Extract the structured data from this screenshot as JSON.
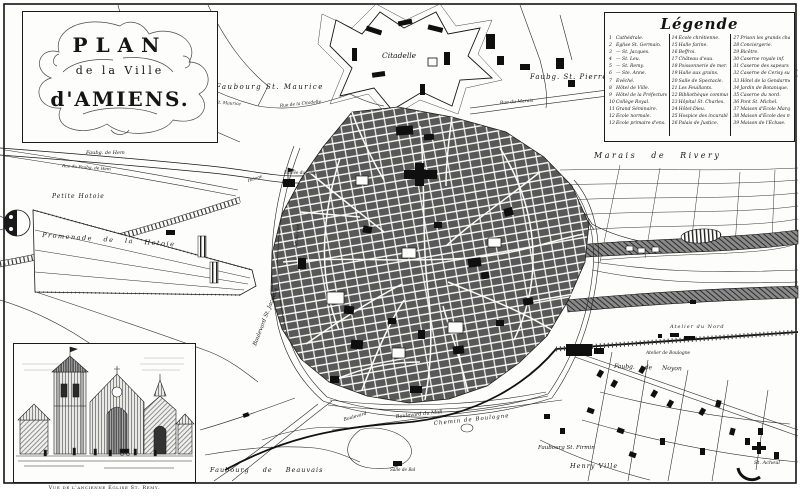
{
  "cartouche": {
    "line1": "PLAN",
    "line2": "de la Ville",
    "line3": "d'AMIENS."
  },
  "legend": {
    "title": "Légende",
    "col1": [
      {
        "n": "1",
        "label": "Cathédrale."
      },
      {
        "n": "2",
        "label": "Église St. Germain."
      },
      {
        "n": "3",
        "label": "—  St. Jacques."
      },
      {
        "n": "4",
        "label": "—  St. Leu."
      },
      {
        "n": "5",
        "label": "—  St. Remy."
      },
      {
        "n": "6",
        "label": "—  Ste. Anne."
      },
      {
        "n": "7",
        "label": "Évêché."
      },
      {
        "n": "8",
        "label": "Hôtel de Ville."
      },
      {
        "n": "9",
        "label": "Hôtel de la Préfecture."
      },
      {
        "n": "10",
        "label": "Collège Royal."
      },
      {
        "n": "11",
        "label": "Grand Séminaire."
      },
      {
        "n": "12",
        "label": "École normale."
      },
      {
        "n": "13",
        "label": "École primaire d'ens. mutuel."
      }
    ],
    "col2": [
      {
        "n": "14",
        "label": "École chrétienne."
      },
      {
        "n": "15",
        "label": "Halle farine."
      },
      {
        "n": "16",
        "label": "Beffroi."
      },
      {
        "n": "17",
        "label": "Château d'eau."
      },
      {
        "n": "18",
        "label": "Poissonnerie de mer."
      },
      {
        "n": "19",
        "label": "Halle aux grains."
      },
      {
        "n": "20",
        "label": "Salle de Spectacle."
      },
      {
        "n": "21",
        "label": "Les Feuillants."
      },
      {
        "n": "22",
        "label": "Bibliothèque communale."
      },
      {
        "n": "23",
        "label": "Hôpital St. Charles."
      },
      {
        "n": "24",
        "label": "Hôtel-Dieu."
      },
      {
        "n": "25",
        "label": "Hospice des incurables."
      },
      {
        "n": "26",
        "label": "Palais de Justice."
      }
    ],
    "col3": [
      {
        "n": "27",
        "label": "Prison les grands chapeaux."
      },
      {
        "n": "28",
        "label": "Conciergerie."
      },
      {
        "n": "29",
        "label": "Bicêtre."
      },
      {
        "n": "30",
        "label": "Caserne royale inf."
      },
      {
        "n": "31",
        "label": "Caserne des sapeurs inf."
      },
      {
        "n": "32",
        "label": "Caserne de Cerisy sup."
      },
      {
        "n": "33",
        "label": "Hôtel de la Gendarmerie."
      },
      {
        "n": "34",
        "label": "Jardin de Botanique."
      },
      {
        "n": "35",
        "label": "Caserne du nord."
      },
      {
        "n": "36",
        "label": "Pont St. Michel."
      },
      {
        "n": "37",
        "label": "Maison d'École Marques."
      },
      {
        "n": "38",
        "label": "Maison d'École des minimes."
      },
      {
        "n": "39",
        "label": "Maison de l'Écluse."
      }
    ]
  },
  "inset": {
    "caption": "Vue de l'ancienne Église St. Remy."
  },
  "labels": {
    "citadelle": "Citadelle",
    "faub_st_pierre": "Faubg. St. Pierre",
    "faubourg_st_maurice": "Faubourg St. Maurice",
    "gde_rue_st_maurice": "Gde. Rue St. Maurice",
    "rue_de_la_citadelle": "Rue de la Citadelle",
    "rue_du_marais": "Rue du Marais",
    "marais_de_rivery": "Marais de Rivery",
    "petite_hotoie": "Petite Hotoie",
    "promenade_hotoie": "Promenade de la Hotoie",
    "faub_de_hem": "Faubg. de Hem",
    "rue_faub_de_hem": "Rue du Faubg. de Hem",
    "entree_du_gare": "Entrée du Gare",
    "halage": "Halage",
    "bd_st_jacques": "Boulevard St. Jacques",
    "bd_du_port": "Bd. du Port",
    "bd_du_midi": "Boulevard du Midi",
    "chemin_de_boulogne": "Chemin de Boulogne",
    "salle_de_bal": "Salle de Bal",
    "faub_st_firmin": "Faubourg St. Firmin",
    "henry_ville": "Henry Ville",
    "faub_de_noyon": "Faubg. de Noyon",
    "atelier_du_nord": "Atelier du Nord",
    "atelier_de_boulogne": "Atelier de Boulogne",
    "st_acheul": "St. Acheul",
    "faubourg_de_beauvais": "Faubourg de Beauvais",
    "boulevard_sw": "Boulevard"
  },
  "colors": {
    "ink": "#151515",
    "paper": "#fdfdfb",
    "city_block_gray": "#585858"
  }
}
